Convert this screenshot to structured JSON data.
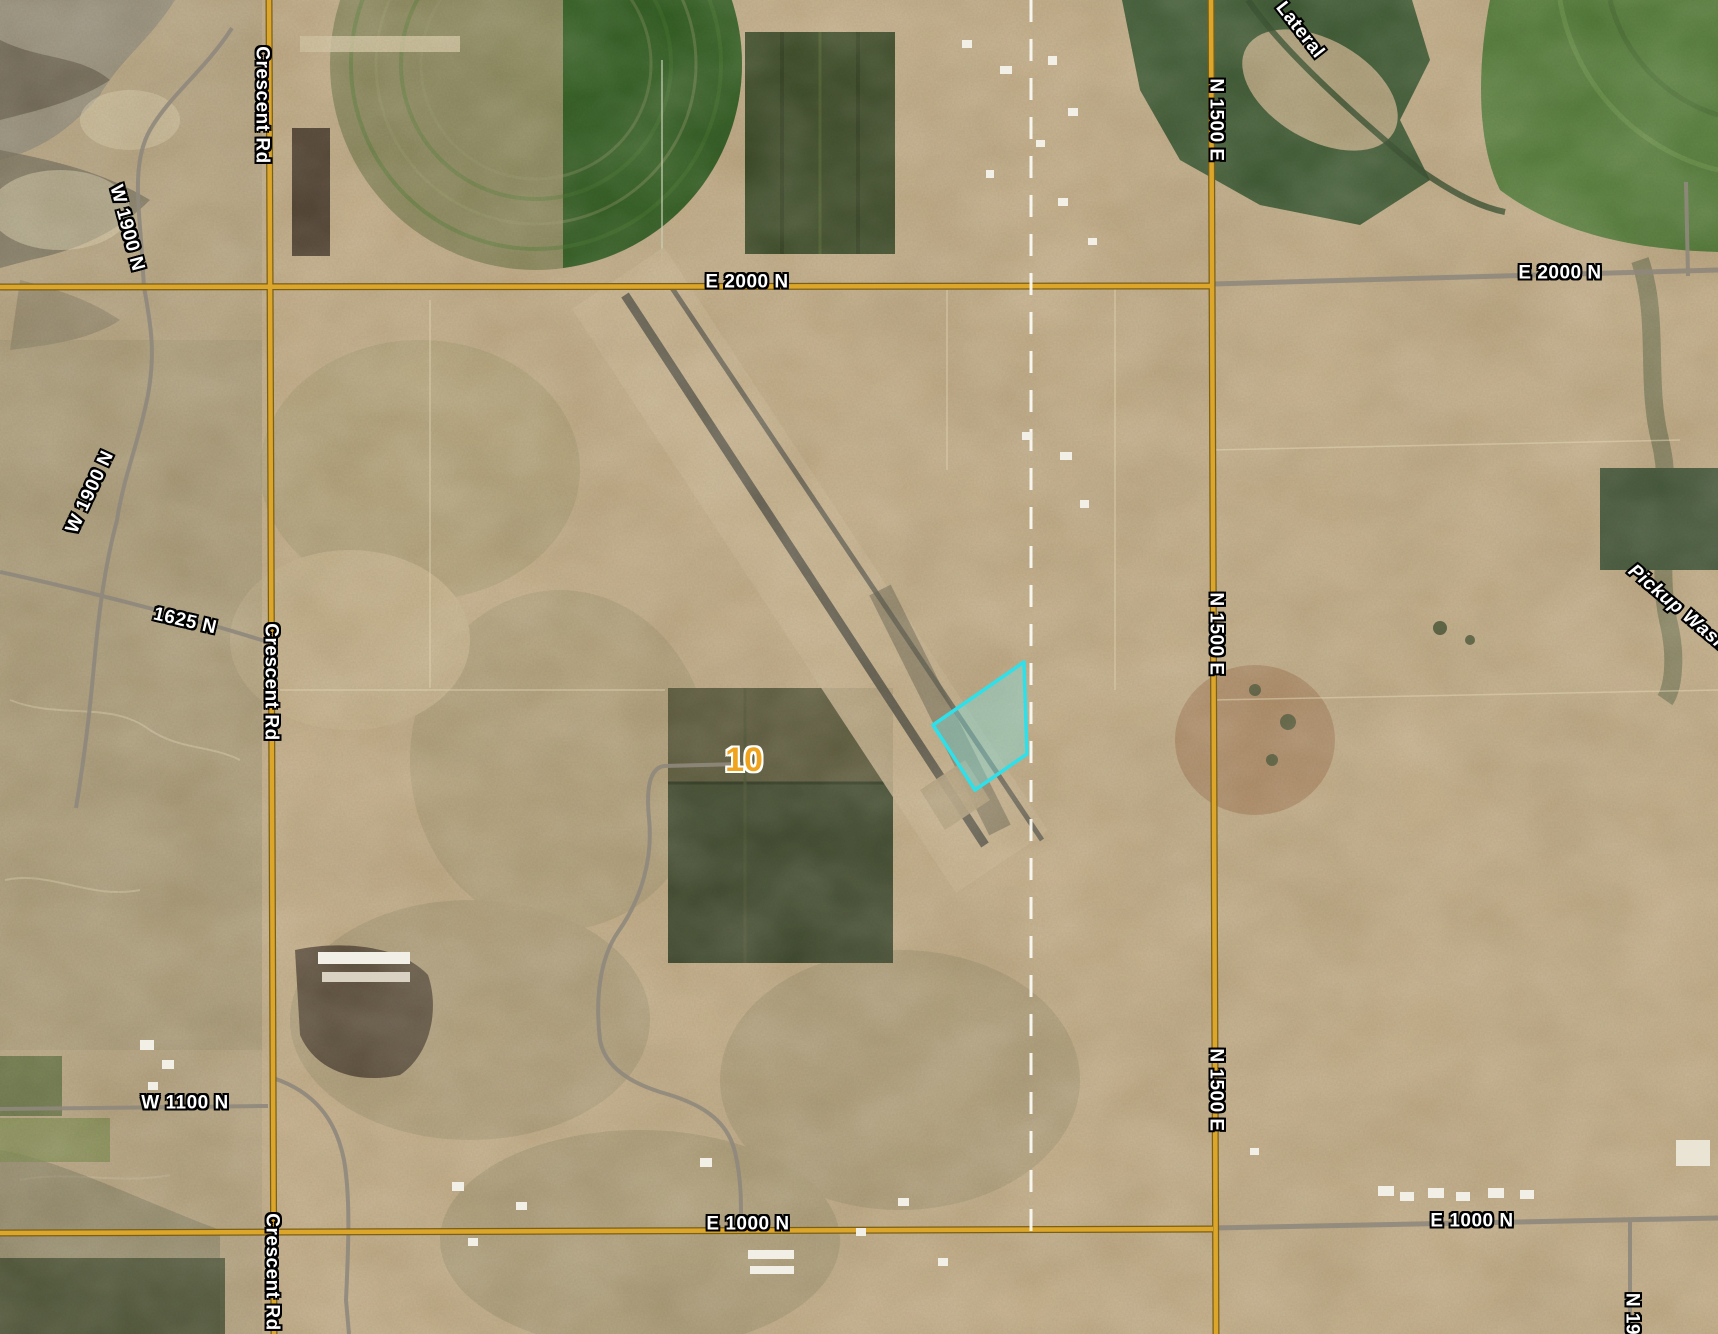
{
  "map": {
    "view": "aerial-imagery-parcel-viewer",
    "route_color": "#DCA62A",
    "section_line_color": "#FAFAF4",
    "highway_marker": {
      "text": "10",
      "color": "#F0A41E"
    },
    "parcel": {
      "outline_color": "#2EE0EA",
      "fill_color": "rgba(126,222,222,0.4)",
      "vertices_px": [
        [
          1024,
          662
        ],
        [
          933,
          725
        ],
        [
          975,
          790
        ],
        [
          1027,
          754
        ]
      ]
    },
    "labels": [
      {
        "id": "crescent-rd-top",
        "text": "Crescent Rd"
      },
      {
        "id": "w-1900-n-upper",
        "text": "W 1900 N"
      },
      {
        "id": "w-1900-n-lower",
        "text": "W 1900 N"
      },
      {
        "id": "road-1625-n",
        "text": "1625 N"
      },
      {
        "id": "crescent-rd-mid",
        "text": "Crescent Rd"
      },
      {
        "id": "e-2000-n-center",
        "text": "E 2000 N"
      },
      {
        "id": "e-2000-n-right",
        "text": "E 2000 N"
      },
      {
        "id": "n-1500-e-top",
        "text": "N 1500 E"
      },
      {
        "id": "n-1500-e-mid",
        "text": "N 1500 E"
      },
      {
        "id": "n-1500-e-bottom",
        "text": "N 1500 E"
      },
      {
        "id": "lateral",
        "text": "Lateral"
      },
      {
        "id": "pickup-wash",
        "text": "Pickup Wash"
      },
      {
        "id": "w-1100-n",
        "text": "W 1100 N"
      },
      {
        "id": "e-1000-n-center",
        "text": "E 1000 N"
      },
      {
        "id": "e-1000-n-right",
        "text": "E 1000 N"
      },
      {
        "id": "crescent-rd-bottom",
        "text": "Crescent Rd"
      },
      {
        "id": "n-19-partial",
        "text": "N 19"
      }
    ]
  }
}
